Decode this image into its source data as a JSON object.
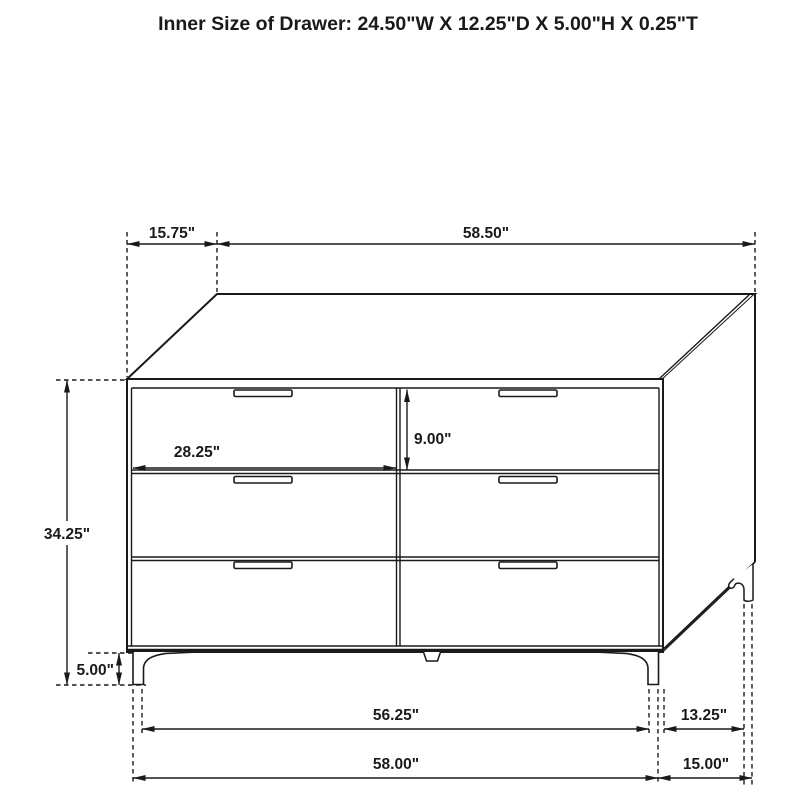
{
  "title": "Inner Size of Drawer: 24.50\"W X 12.25\"D X 5.00\"H X 0.25\"T",
  "dims": {
    "top_depth": "15.75\"",
    "top_width": "58.50\"",
    "drawer_width": "28.25\"",
    "drawer_opening_height": "9.00\"",
    "height": "34.25\"",
    "leg_height": "5.00\"",
    "feet_span": "56.25\"",
    "overall_width": "58.00\"",
    "leg_depth_span": "13.25\"",
    "depth": "15.00\""
  },
  "colors": {
    "line": "#1a1a1a",
    "background": "#ffffff"
  }
}
